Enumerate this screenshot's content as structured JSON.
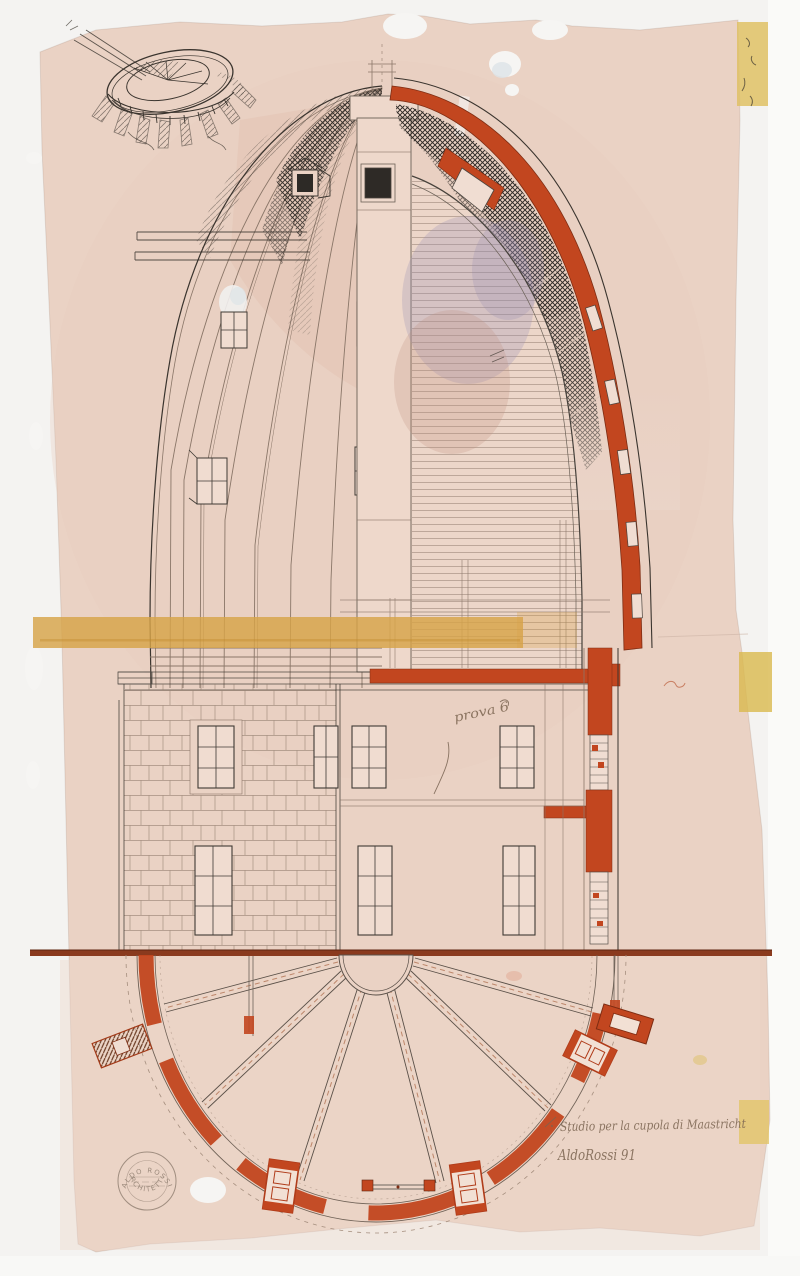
{
  "artwork": {
    "inscription_title": "Studio per la cupola di Maastricht",
    "signature": "AldoRossi 91",
    "annotation_note": "prova 6",
    "stamp_text_top": "ALDO ROSSI",
    "stamp_text_bottom": "ARCHITETTO"
  },
  "colors": {
    "paper": "#ead2c4",
    "scan_background": "#f4f3f1",
    "red_ink": "#c2461f",
    "dark_red": "#7e2c12",
    "ochre_band": "#d7a348",
    "tape": "#dfc165",
    "ground_line": "#8a3a1e",
    "pen_ink": "#3a342e",
    "drafting_line": "#8a7668",
    "wash_blue": "#9a90b4",
    "wash_pink": "#c08e80",
    "handwriting_ink": "#7b6450"
  }
}
